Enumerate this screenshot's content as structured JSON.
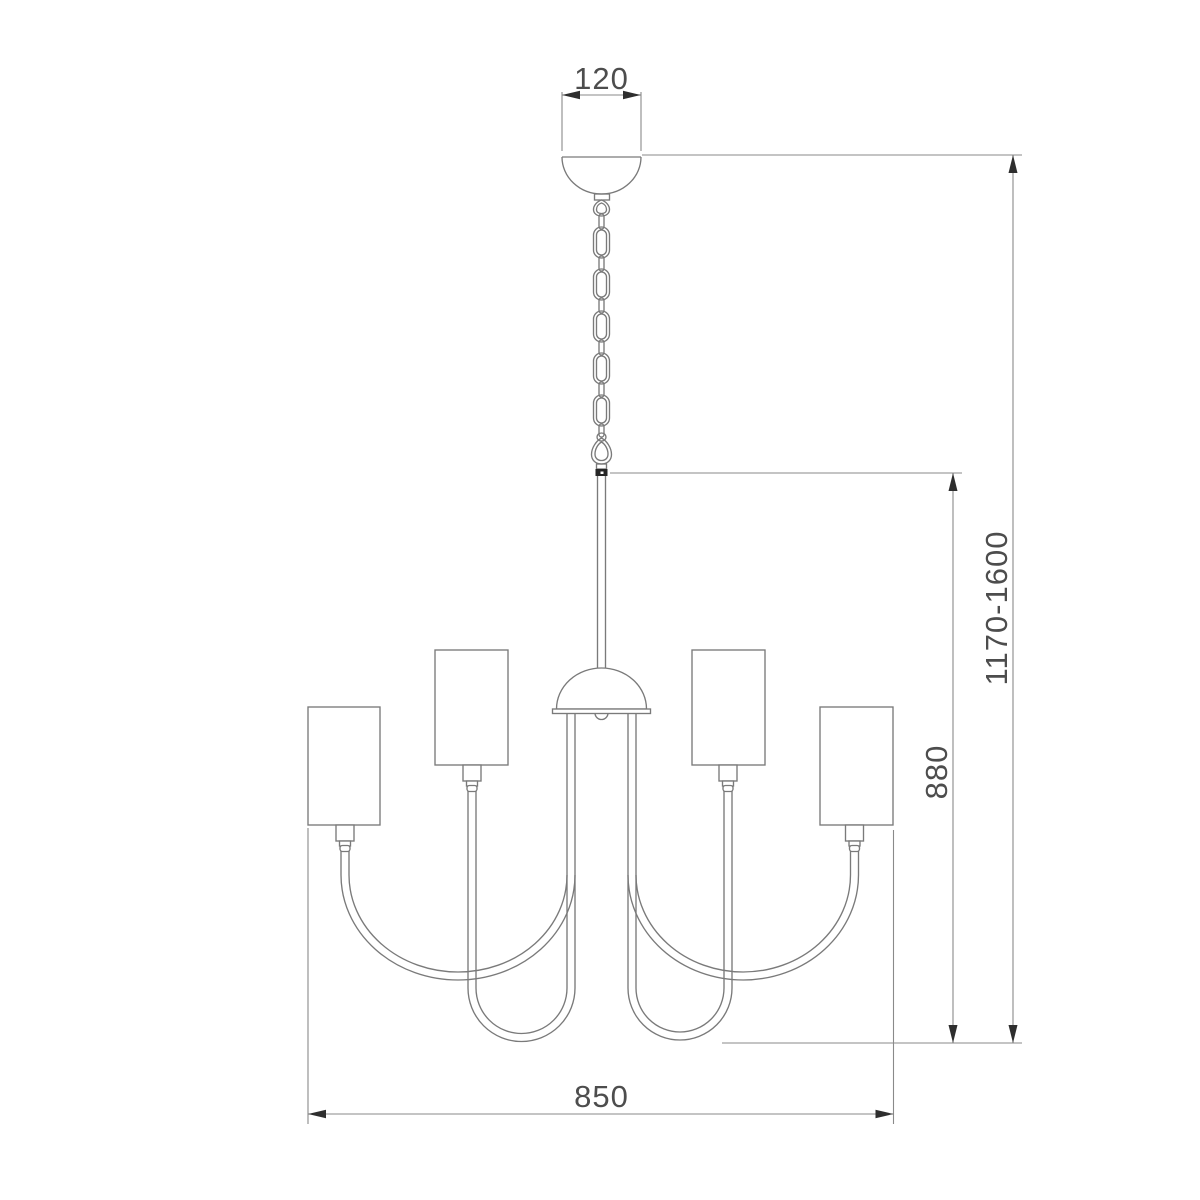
{
  "drawing": {
    "dimensions": {
      "canopy_width": "120",
      "overall_height_range": "1170-1600",
      "body_drop": "880",
      "body_width": "850"
    },
    "colors": {
      "background": "#ffffff",
      "outline": "#7a7a7a",
      "dimension_line": "#8a8a8a",
      "arrowhead": "#2e2e2e",
      "label_text": "#4d4d4d",
      "connector_band": "#262626"
    }
  }
}
